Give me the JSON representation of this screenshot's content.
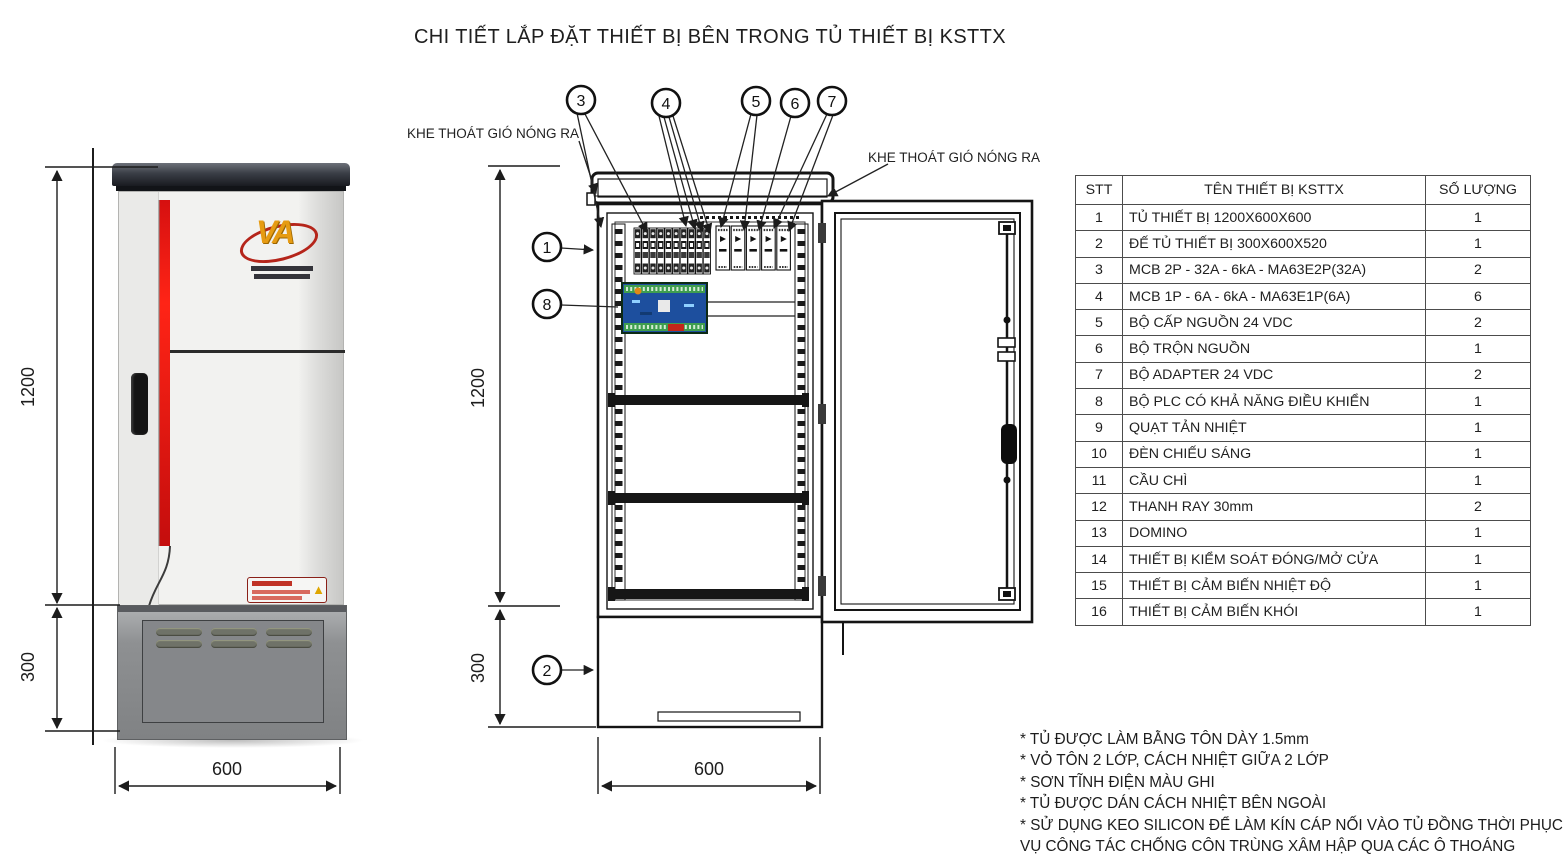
{
  "title": "CHI TIẾT LẮP ĐẶT THIẾT BỊ BÊN TRONG TỦ THIẾT BỊ KSTTX",
  "labels": {
    "vent_left": "KHE THOÁT GIÓ NÓNG RA",
    "vent_right": "KHE THOÁT GIÓ NÓNG RA"
  },
  "dimensions": {
    "height": "1200",
    "base_height": "300",
    "width": "600"
  },
  "callouts": [
    "1",
    "2",
    "3",
    "4",
    "5",
    "6",
    "7",
    "8"
  ],
  "table": {
    "headers": [
      "STT",
      "TÊN THIẾT BỊ KSTTX",
      "SỐ LƯỢNG"
    ],
    "rows": [
      [
        "1",
        "TỦ THIẾT BỊ 1200X600X600",
        "1"
      ],
      [
        "2",
        "ĐẾ TỦ THIẾT BỊ 300X600X520",
        "1"
      ],
      [
        "3",
        "MCB 2P - 32A - 6kA - MA63E2P(32A)",
        "2"
      ],
      [
        "4",
        "MCB 1P - 6A - 6kA - MA63E1P(6A)",
        "6"
      ],
      [
        "5",
        "BỘ CẤP NGUỒN 24 VDC",
        "2"
      ],
      [
        "6",
        "BỘ TRỘN NGUỒN",
        "1"
      ],
      [
        "7",
        "BỘ ADAPTER 24 VDC",
        "2"
      ],
      [
        "8",
        "BỘ PLC CÓ KHẢ NĂNG ĐIỀU KHIỂN",
        "1"
      ],
      [
        "9",
        "QUẠT TẢN NHIỆT",
        "1"
      ],
      [
        "10",
        "ĐÈN CHIẾU SÁNG",
        "1"
      ],
      [
        "11",
        "CẦU CHÌ",
        "1"
      ],
      [
        "12",
        "THANH RAY 30mm",
        "2"
      ],
      [
        "13",
        "DOMINO",
        "1"
      ],
      [
        "14",
        "THIẾT BỊ KIỂM SOÁT ĐÓNG/MỞ CỬA",
        "1"
      ],
      [
        "15",
        "THIẾT BỊ CẢM BIẾN NHIỆT ĐỘ",
        "1"
      ],
      [
        "16",
        "THIẾT BỊ CẢM BIẾN KHÓI",
        "1"
      ]
    ]
  },
  "notes": [
    "* TỦ ĐƯỢC LÀM BẰNG TÔN DÀY 1.5mm",
    "* VỎ TÔN 2 LỚP, CÁCH NHIỆT GIỮA 2 LỚP",
    "* SƠN TĨNH ĐIỆN MÀU GHI",
    "* TỦ ĐƯỢC DÁN CÁCH NHIỆT BÊN NGOÀI",
    "* SỬ DỤNG KEO SILICON ĐỂ LÀM KÍN CÁP NỐI VÀO TỦ ĐỒNG THỜI PHỤC",
    "VỤ CÔNG TÁC CHỐNG CÔN TRÙNG XÂM HẬP QUA CÁC Ô THOÁNG"
  ],
  "colors": {
    "line": "#1a1a1a",
    "accent_red": "#e01010",
    "logo_orange": "#e69b12",
    "plc_blue": "#1d4f9e",
    "plc_green": "#3f9e4f"
  }
}
